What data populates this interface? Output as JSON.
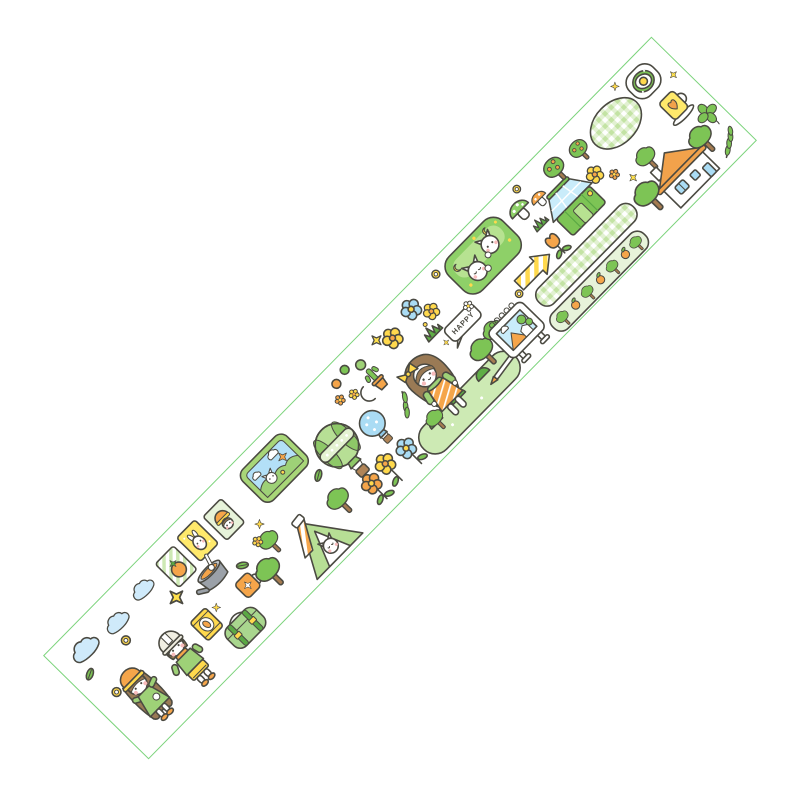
{
  "tape": {
    "happy_sign_text": "HAPPY",
    "product_type": "washi tape sticker strip",
    "theme": "kawaii camping and picnic illustration",
    "background_color": "#ffffff",
    "palette": {
      "tape_border": "#7bd37b",
      "outline": "#4b4a42",
      "green": "#7dc455",
      "dark_green": "#5aa844",
      "light_green": "#b7e291",
      "pale_green": "#e7f3da",
      "yellow": "#ffd94d",
      "orange": "#f5a54a",
      "blue": "#aadcf4",
      "sky_blue": "#cfeafa",
      "brown": "#a57b50",
      "hair_brown": "#9a7a55",
      "blush_pink": "#f8bcbc",
      "grey": "#9ba1a8",
      "white": "#ffffff"
    },
    "motifs": [
      {
        "name": "blue-clouds",
        "desc": "three small blue outlined clouds"
      },
      {
        "name": "hiking-girl",
        "desc": "girl in orange bucket hat with yellow brim, green dress with white pocket"
      },
      {
        "name": "hiking-boy",
        "desc": "boy in cream helmet, orange scarf, green jacket, yellow shorts"
      },
      {
        "name": "coin-rings",
        "desc": "small yellow ring buttons"
      },
      {
        "name": "sparkle-stars",
        "desc": "yellow four-point stars and cross sparkles"
      },
      {
        "name": "photo-card-persimmon",
        "desc": "striped card with persimmon fruit"
      },
      {
        "name": "photo-card-rabbit",
        "desc": "yellow card with white rabbit"
      },
      {
        "name": "photo-card-girl",
        "desc": "card with girl in orange hood"
      },
      {
        "name": "snack-bag",
        "desc": "yellow snack pouch"
      },
      {
        "name": "camp-pot",
        "desc": "grey pot with orange soup and ladle"
      },
      {
        "name": "flower-mug",
        "desc": "orange mug with white flower"
      },
      {
        "name": "camping-bag",
        "desc": "green camp bag with dark straps and yellow buckles"
      },
      {
        "name": "leaves",
        "desc": "single green leaves"
      },
      {
        "name": "trees",
        "desc": "round green trees with brown trunks"
      },
      {
        "name": "tent-with-cat",
        "desc": "green tent with orange striped awning and white cat peeking out"
      },
      {
        "name": "landscape-frame",
        "desc": "green frame picture: sky, clouds, hills, white cat, flowers"
      },
      {
        "name": "hot-air-balloon-green",
        "desc": "large green striped balloon with dotted band and basket"
      },
      {
        "name": "hot-air-balloon-blue",
        "desc": "small blue dotted balloon with basket"
      },
      {
        "name": "crescent-moon",
        "desc": "yellow crescent moon"
      },
      {
        "name": "potted-cactus",
        "desc": "green cactus in orange pot"
      },
      {
        "name": "fruit-balls",
        "desc": "small green and orange balls"
      },
      {
        "name": "stem-flowers",
        "desc": "orange, yellow and blue flowers with stems and leaves"
      },
      {
        "name": "leaf-sprig",
        "desc": "leafy twig"
      },
      {
        "name": "grass-hill",
        "desc": "light green hill with dark bushes and small trees"
      },
      {
        "name": "picnic-girl",
        "desc": "girl with yellow bow, long brown hair, striped orange pinafore over green top"
      },
      {
        "name": "happy-sign",
        "desc": "white speech bubble sign reading HAPPY"
      },
      {
        "name": "grass-tufts",
        "desc": "dark green grass sprouts with yellow dot"
      },
      {
        "name": "easel-board",
        "desc": "white ring-bound board with landscape painting, legs and orange-tipped pole"
      },
      {
        "name": "striped-arrow",
        "desc": "yellow diagonally striped arrow sign"
      },
      {
        "name": "cat-bed-hedge",
        "desc": "green pad with two white cats, yellow moons and dots"
      },
      {
        "name": "mushrooms",
        "desc": "green-cap mushroom with white dots and small orange mushroom"
      },
      {
        "name": "tulip",
        "desc": "orange tulip with leaves"
      },
      {
        "name": "gingham-ribbon",
        "desc": "long green gingham checkered band"
      },
      {
        "name": "orchard-ribbon",
        "desc": "pale green band with mini trees and oranges"
      },
      {
        "name": "greenhouse",
        "desc": "green greenhouse with blue glass roof"
      },
      {
        "name": "fruit-trees",
        "desc": "trees dotted with orange fruit"
      },
      {
        "name": "flower-clusters",
        "desc": "yellow and orange wildflowers"
      },
      {
        "name": "house",
        "desc": "white house with orange roof, chimney and blue windows"
      },
      {
        "name": "gingham-blanket",
        "desc": "rounded gingham picnic blanket"
      },
      {
        "name": "fried-egg-plate",
        "desc": "plate of greens with fried egg"
      },
      {
        "name": "heart-mug",
        "desc": "yellow mug with orange heart on saucer"
      },
      {
        "name": "four-leaf-clover",
        "desc": "lucky four-leaf clover"
      },
      {
        "name": "leaf-branch",
        "desc": "branch with small leaves"
      }
    ]
  }
}
